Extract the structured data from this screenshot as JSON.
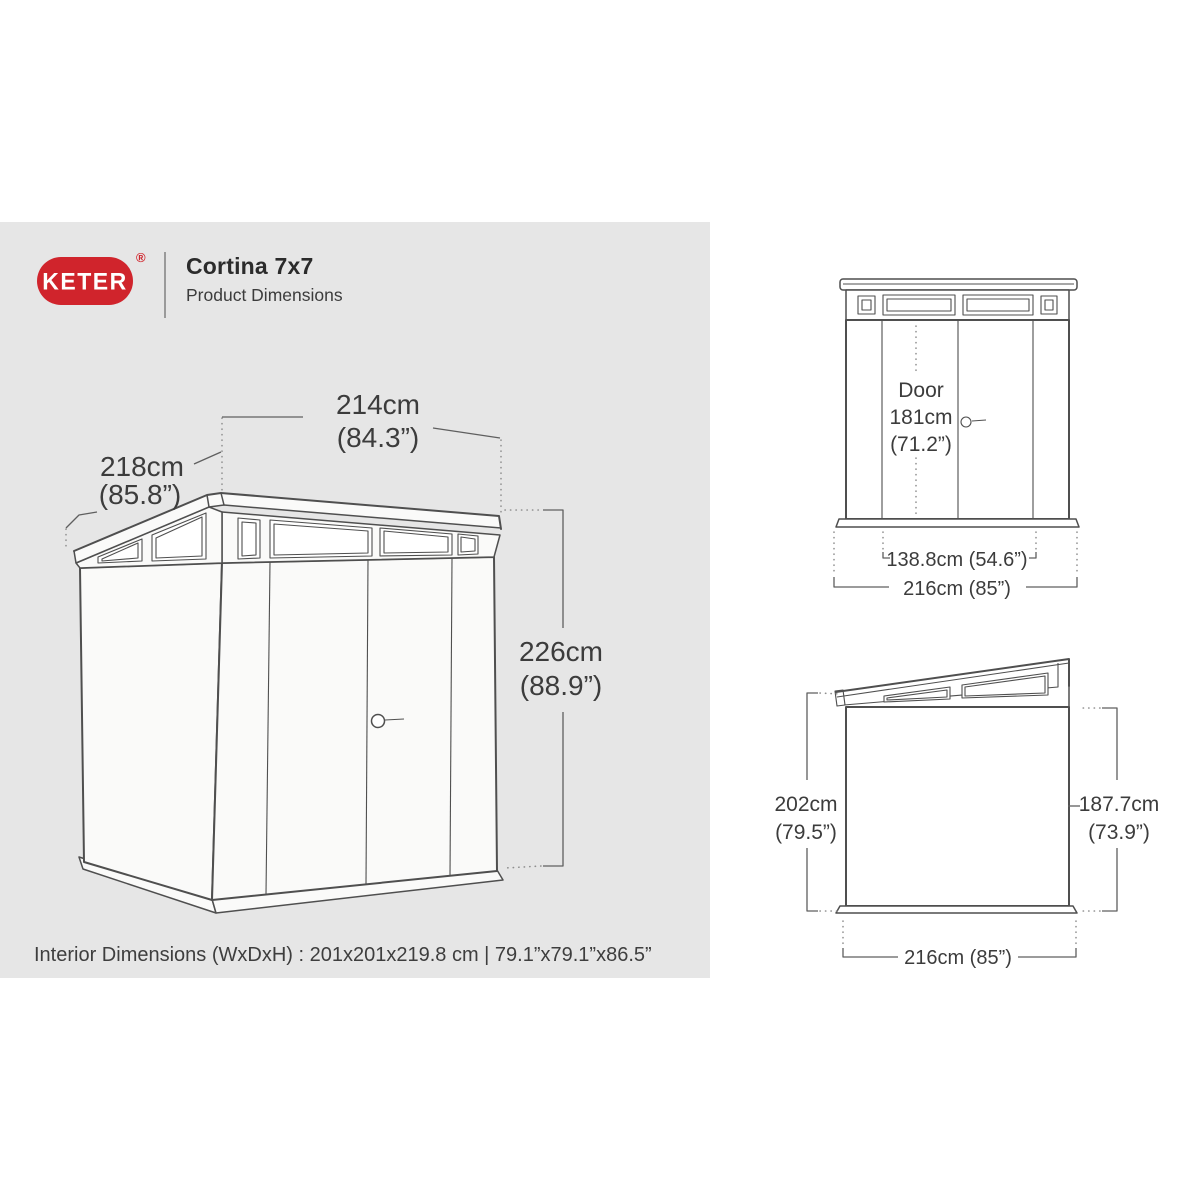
{
  "header": {
    "brand": "KETER",
    "registered": "®",
    "title": "Cortina 7x7",
    "subtitle": "Product Dimensions"
  },
  "colors": {
    "brand_red": "#d0242c",
    "panel_gray": "#e6e6e6",
    "line_gray": "#4f4f4f",
    "text_gray": "#3c3c3c"
  },
  "iso_view": {
    "width_cm": "214cm",
    "width_in": "(84.3”)",
    "depth_cm": "218cm",
    "depth_in": "(85.8”)",
    "height_cm": "226cm",
    "height_in": "(88.9”)"
  },
  "interior_note": "Interior Dimensions (WxDxH) : 201x201x219.8 cm | 79.1”x79.1”x86.5”",
  "front_view": {
    "door_label": "Door",
    "door_height_cm": "181cm",
    "door_height_in": "(71.2”)",
    "door_width": "138.8cm (54.6”)",
    "total_width": "216cm (85”)"
  },
  "side_view": {
    "high_side_cm": "202cm",
    "high_side_in": "(79.5”)",
    "low_side_cm": "187.7cm",
    "low_side_in": "(73.9”)",
    "width": "216cm (85”)"
  }
}
